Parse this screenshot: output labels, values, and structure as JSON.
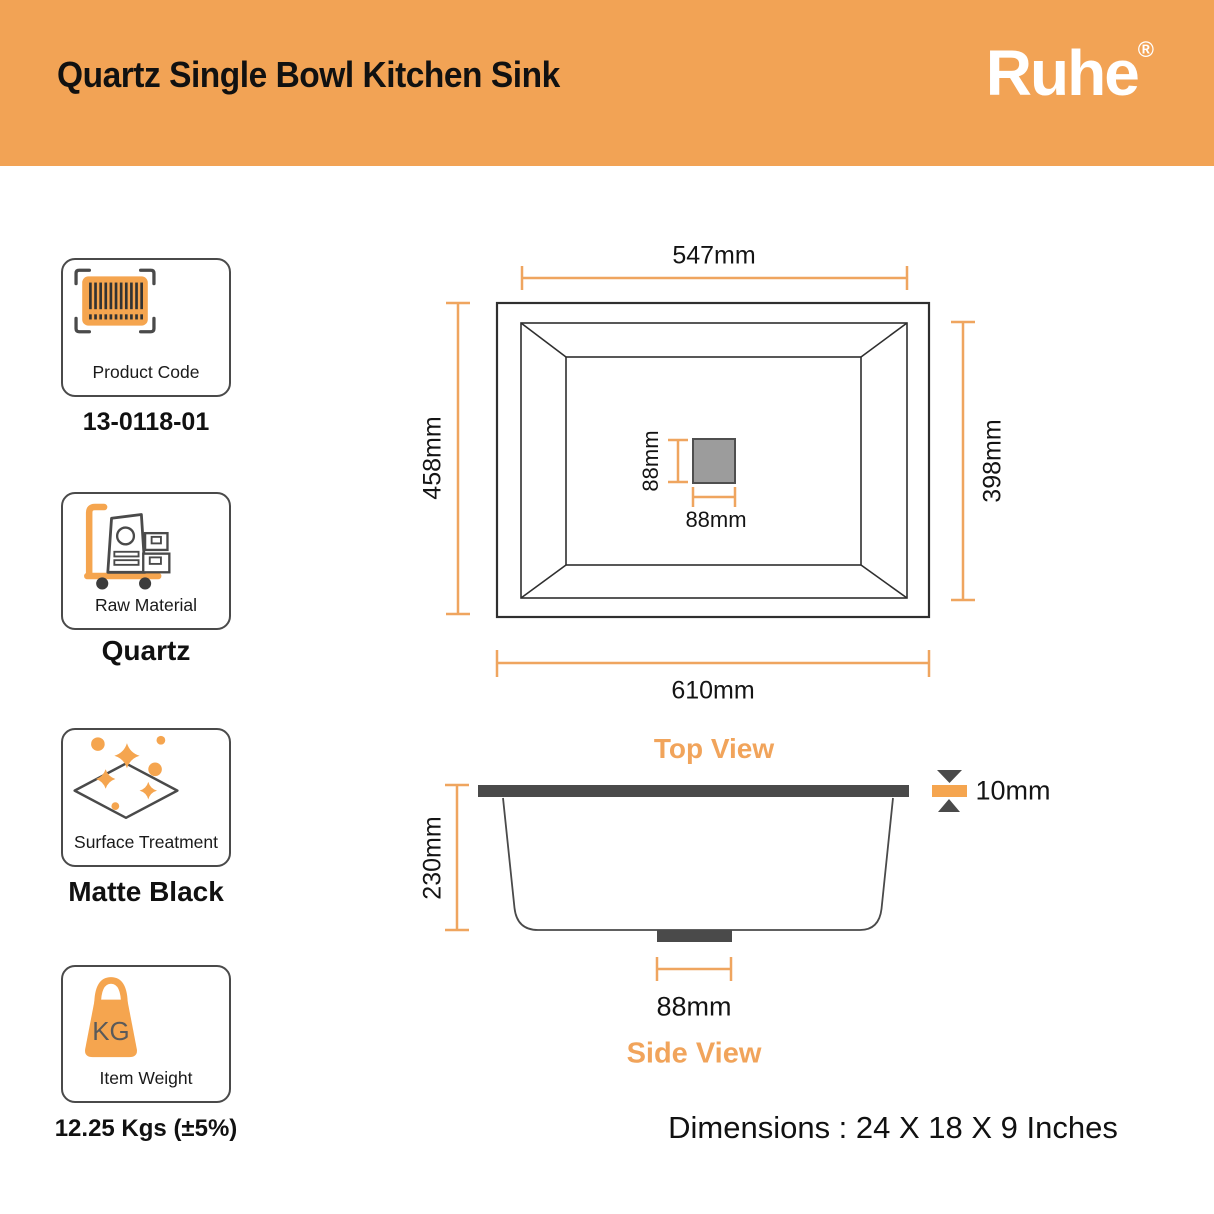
{
  "header": {
    "title": "Quartz Single Bowl Kitchen Sink",
    "brand": "Ruhe",
    "registered": "®"
  },
  "specs": [
    {
      "label": "Product Code",
      "value": "13-0118-01",
      "icon": "barcode-icon"
    },
    {
      "label": "Raw Material",
      "value": "Quartz",
      "icon": "material-trolley-icon"
    },
    {
      "label": "Surface Treatment",
      "value": "Matte Black",
      "icon": "sparkle-clean-icon"
    },
    {
      "label": "Item Weight",
      "value": "12.25 Kgs (±5%)",
      "icon": "kg-weight-icon",
      "icon_text": "KG"
    }
  ],
  "diagram": {
    "top_view": {
      "label": "Top View",
      "width_top": "547mm",
      "height_left": "458mm",
      "height_right": "398mm",
      "width_bottom": "610mm",
      "drain_height": "88mm",
      "drain_width": "88mm"
    },
    "side_view": {
      "label": "Side View",
      "depth": "230mm",
      "flange_thickness": "10mm",
      "drain_width": "88mm"
    },
    "footer": "Dimensions : 24 X 18 X 9 Inches"
  },
  "colors": {
    "accent_orange": "#F2A355",
    "dimension_line": "#EFA55F",
    "dark_gray": "#4a4a4a",
    "drain_fill": "#9c9c9c"
  }
}
